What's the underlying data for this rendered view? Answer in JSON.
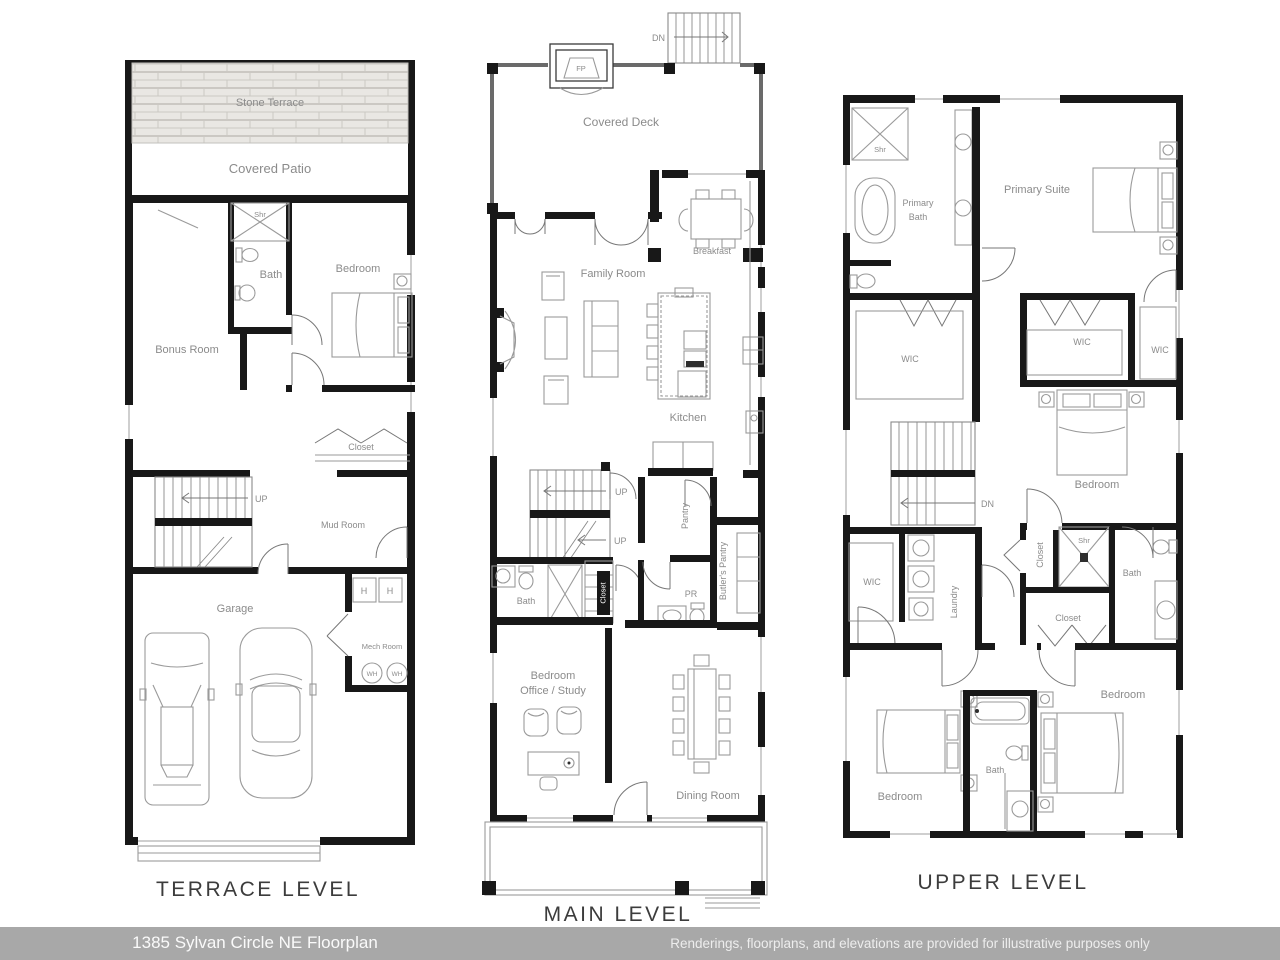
{
  "footer": {
    "address": "1385 Sylvan Circle NE Floorplan",
    "disclaimer": "Renderings, floorplans, and elevations are provided for illustrative purposes only"
  },
  "terrace": {
    "title": "TERRACE LEVEL",
    "labels": {
      "stone_terrace": "Stone Terrace",
      "covered_patio": "Covered Patio",
      "shr": "Shr",
      "bath": "Bath",
      "bedroom": "Bedroom",
      "bonus_room": "Bonus Room",
      "closet": "Closet",
      "up": "UP",
      "mud_room": "Mud Room",
      "garage": "Garage",
      "mech_room": "Mech Room",
      "h": "H",
      "wh": "WH"
    }
  },
  "main": {
    "title": "MAIN LEVEL",
    "labels": {
      "dn": "DN",
      "fp": "FP",
      "covered_deck": "Covered Deck",
      "breakfast": "Breakfast",
      "family_room": "Family Room",
      "kitchen": "Kitchen",
      "up": "UP",
      "pantry": "Pantry",
      "butlers_pantry": "Butler's Pantry",
      "bath": "Bath",
      "closet": "Closet",
      "pr": "PR",
      "bedroom_office_line1": "Bedroom",
      "bedroom_office_line2": "Office / Study",
      "dining_room": "Dining Room"
    }
  },
  "upper": {
    "title": "UPPER LEVEL",
    "labels": {
      "shr": "Shr",
      "primary_bath_line1": "Primary",
      "primary_bath_line2": "Bath",
      "primary_suite": "Primary Suite",
      "wic": "WIC",
      "dn": "DN",
      "bedroom": "Bedroom",
      "closet": "Closet",
      "bath": "Bath",
      "laundry": "Laundry"
    }
  },
  "colors": {
    "footer_bg": "#a8a8a8",
    "footer_text": "#fafafa",
    "wall": "#181818",
    "room_label": "#8b8b8b",
    "title_text": "#3c3c3c"
  }
}
